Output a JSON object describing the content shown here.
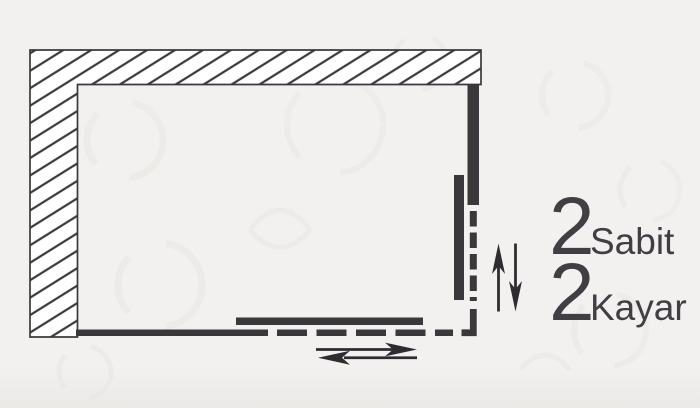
{
  "labels": {
    "fixed_count": "2",
    "fixed_name": "Sabit",
    "sliding_count": "2",
    "sliding_name": "Kayar"
  },
  "colors": {
    "background": "#f2f1ef",
    "wall_ink": "#3b393d",
    "panel": "#3a383b",
    "arrow": "#2e2c30",
    "text": "#413f44"
  },
  "diagram": {
    "type": "shower-enclosure-floor-plan",
    "elements": [
      "hatched-wall-top",
      "hatched-wall-left",
      "right-fixed-panel",
      "right-sliding-panel",
      "right-opening-dashed-line",
      "bottom-fixed-panel",
      "bottom-sliding-panel",
      "bottom-opening-dashed-line",
      "vertical-slide-direction-arrows",
      "horizontal-slide-direction-arrows"
    ]
  }
}
